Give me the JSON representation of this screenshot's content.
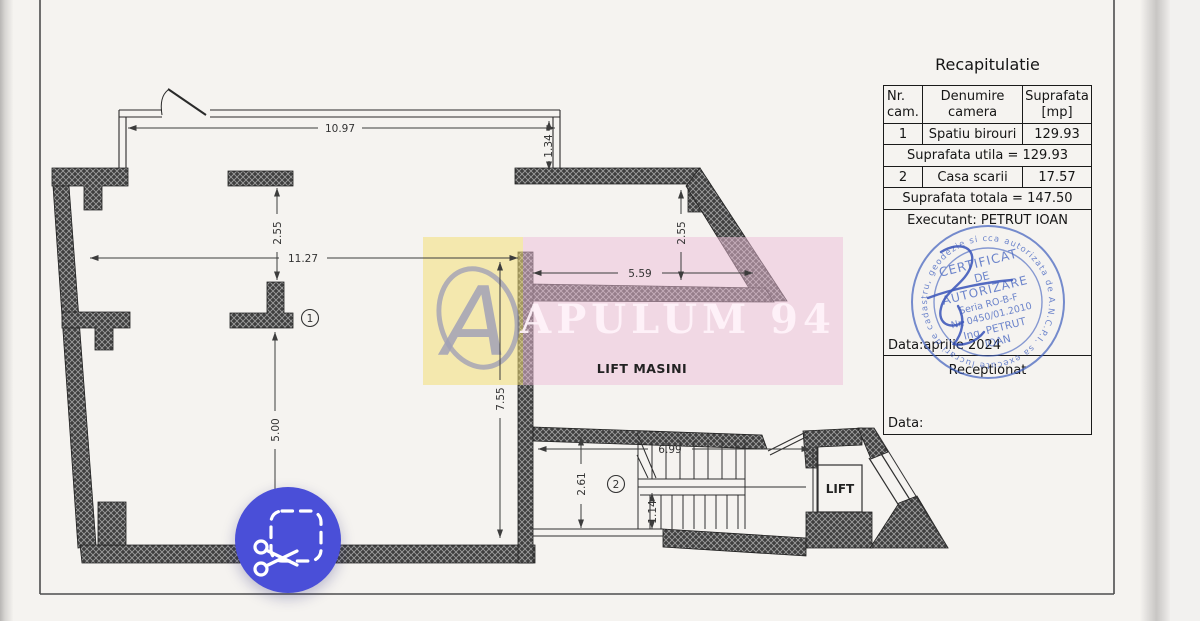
{
  "recap": {
    "title": "Recapitulatie",
    "header": {
      "col1_line1": "Nr.",
      "col1_line2": "cam.",
      "col2_line1": "Denumire",
      "col2_line2": "camera",
      "col3_line1": "Suprafata",
      "col3_line2": "[mp]"
    },
    "row1": {
      "nr": "1",
      "name": "Spatiu birouri",
      "area": "129.93"
    },
    "subtotal": "Suprafata utila = 129.93",
    "row2": {
      "nr": "2",
      "name": "Casa scarii",
      "area": "17.57"
    },
    "total": "Suprafata totala = 147.50",
    "executant": "Executant: PETRUT IOAN",
    "date_line": "Data:aprilie 2024",
    "receptionat": "Receptionat",
    "date_label": "Data:"
  },
  "dimensions": {
    "top_width": "10.97",
    "entry_depth": "1.34",
    "upper_left_depth": "2.55",
    "room_width": "11.27",
    "wing_depth": "2.55",
    "wing_width": "5.59",
    "right_depth": "7.55",
    "lower_left_depth": "5.00",
    "stairs_width": "6.99",
    "stairs_depth": "2.61",
    "flight_width": "1.14"
  },
  "rooms": {
    "room1_number": "1",
    "room2_number": "2",
    "lift_masini_label": "LIFT MASINI",
    "lift_label": "LIFT"
  },
  "watermark": {
    "brand": "APULUM 94"
  },
  "stamp": {
    "ring": "ca autorizata de A.N.C.P.I. sa execute lucrari de cadastru, geodezie si cartografie",
    "line1": "CERTIFICAT",
    "line2": "DE",
    "line3": "AUTORIZARE",
    "line4": "Seria RO-B-F",
    "line5": "Nr. 0450/01.2010",
    "line6": "Ing. PETRUT",
    "line7": "IOAN"
  },
  "colors": {
    "button_blue": "#4a4fd8",
    "stamp_blue": "#3e5fbe",
    "watermark_pink": "#eebed8",
    "watermark_yellow": "#f2de78",
    "paper": "#f5f3f0",
    "wall_dark": "#3f3f3f"
  },
  "icons": {
    "snip_button": "scissors-snip-icon"
  }
}
